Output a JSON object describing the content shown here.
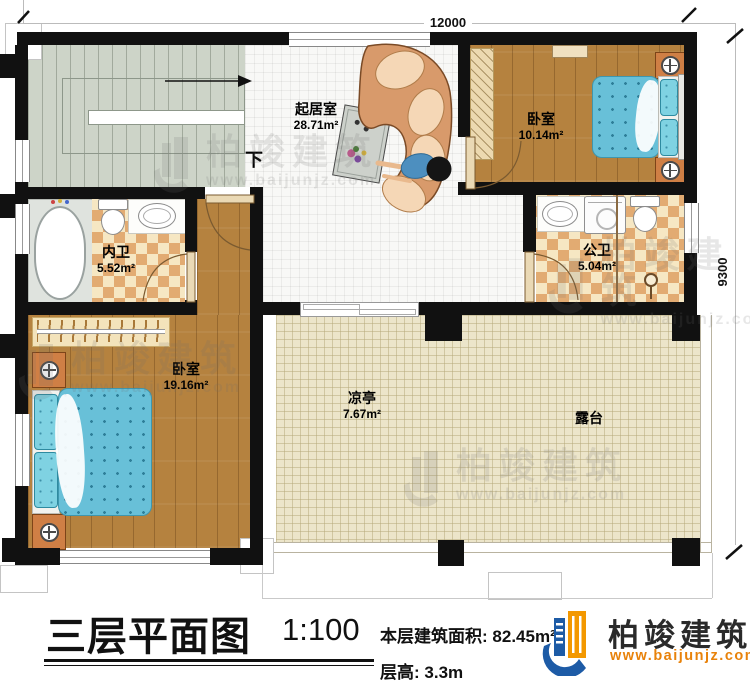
{
  "plan": {
    "dim_top": "12000",
    "dim_right": "9300",
    "stairs_down": "下",
    "rooms": {
      "living": {
        "name": "起居室",
        "area": "28.71m²"
      },
      "bedroom1": {
        "name": "卧室",
        "area": "10.14m²"
      },
      "ensuite": {
        "name": "内卫",
        "area": "5.52m²"
      },
      "public": {
        "name": "公卫",
        "area": "5.04m²"
      },
      "bedroom2": {
        "name": "卧室",
        "area": "19.16m²"
      },
      "pavilion": {
        "name": "凉亭",
        "area": "7.67m²"
      },
      "terrace": {
        "name": "露台"
      }
    }
  },
  "title_block": {
    "title": "三层平面图",
    "scale": "1:100",
    "area_label": "本层建筑面积:",
    "area_value": "82.45m²",
    "height_label": "层高:",
    "height_value": "3.3m"
  },
  "branding": {
    "company": "柏竣建筑",
    "website": "www.baijunjz.com",
    "blue": "#1d5ba6",
    "orange": "#f39800"
  }
}
